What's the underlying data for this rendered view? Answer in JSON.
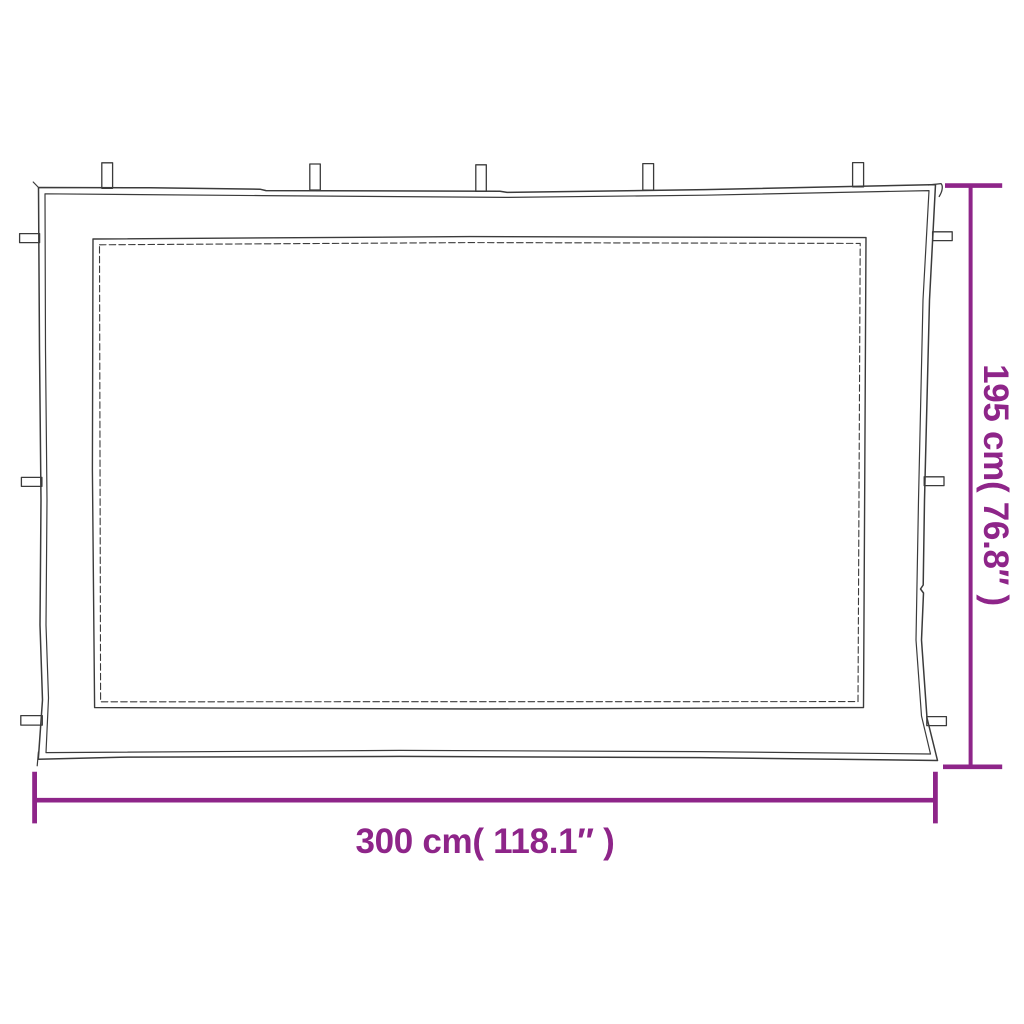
{
  "diagram": {
    "dimensions": {
      "width_label": "300 cm( 118.1″ )",
      "height_label": "195 cm( 76.8″ )"
    },
    "colors": {
      "dimension": "#8E2589",
      "outline": "#3B3B3B",
      "background": "#FFFFFF"
    },
    "tabs": {
      "top_count": 5,
      "left_count": 3,
      "right_count": 3
    }
  }
}
